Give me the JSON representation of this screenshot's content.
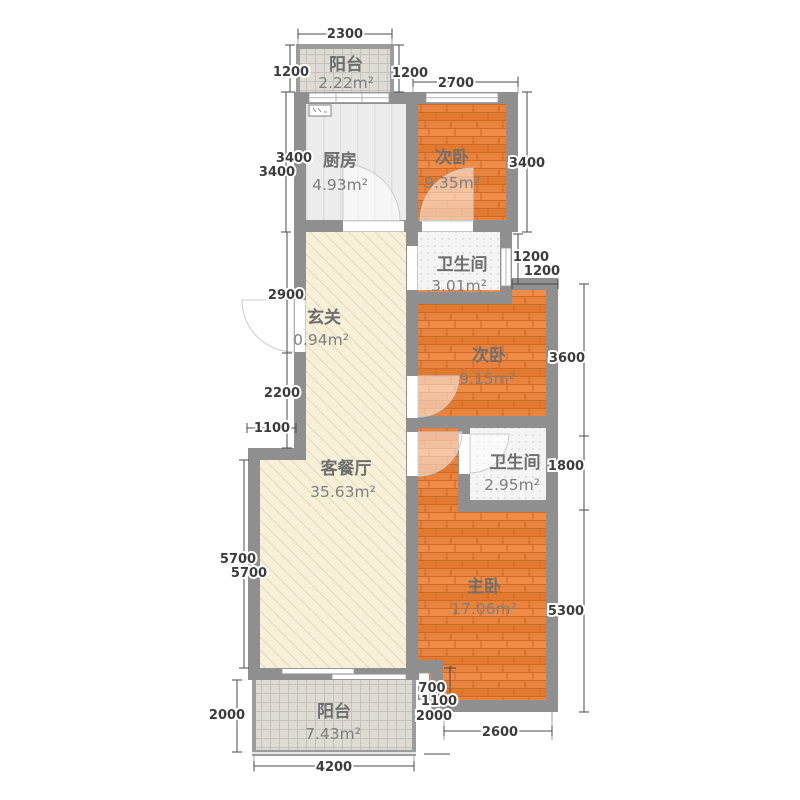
{
  "palette": {
    "wall": "#8f8f8f",
    "wood_floor": "#e8823c",
    "living_floor": "#f7f0d8",
    "kitchen_floor": "#ececec",
    "bath_floor": "#f4f4f4",
    "balcony_floor": "#dedbd5",
    "dim_text": "#3c3c3c",
    "room_text": "#6e6e6e"
  },
  "rooms": [
    {
      "name": "阳台",
      "area": "2.22m²"
    },
    {
      "name": "厨房",
      "area": "4.93m²"
    },
    {
      "name": "次卧",
      "area": "9.35m²"
    },
    {
      "name": "卫生间",
      "area": "3.01m²"
    },
    {
      "name": "玄关",
      "area": "0.94m²"
    },
    {
      "name": "次卧",
      "area": "9.15m²"
    },
    {
      "name": "卫生间",
      "area": "2.95m²"
    },
    {
      "name": "客餐厅",
      "area": "35.63m²"
    },
    {
      "name": "主卧",
      "area": "17.06m²"
    },
    {
      "name": "阳台",
      "area": "7.43m²"
    }
  ],
  "dims": {
    "top_2300": "2300",
    "top_1200_left": "1200",
    "top_1200_right": "1200",
    "top_2700": "2700",
    "left_3400_a": "3400",
    "left_3400_b": "3400",
    "left_2900": "2900",
    "left_2200": "2200",
    "left_1100": "1100",
    "left_5700_a": "5700",
    "left_5700_b": "5700",
    "left_2000": "2000",
    "bottom_4200": "4200",
    "bottom_2600": "2600",
    "right_3400": "3400",
    "right_1200_a": "1200",
    "right_1200_b": "1200",
    "right_3600": "3600",
    "right_1800": "1800",
    "right_5300": "5300",
    "right_700": "700",
    "right_1100": "1100",
    "right_2000": "2000"
  }
}
